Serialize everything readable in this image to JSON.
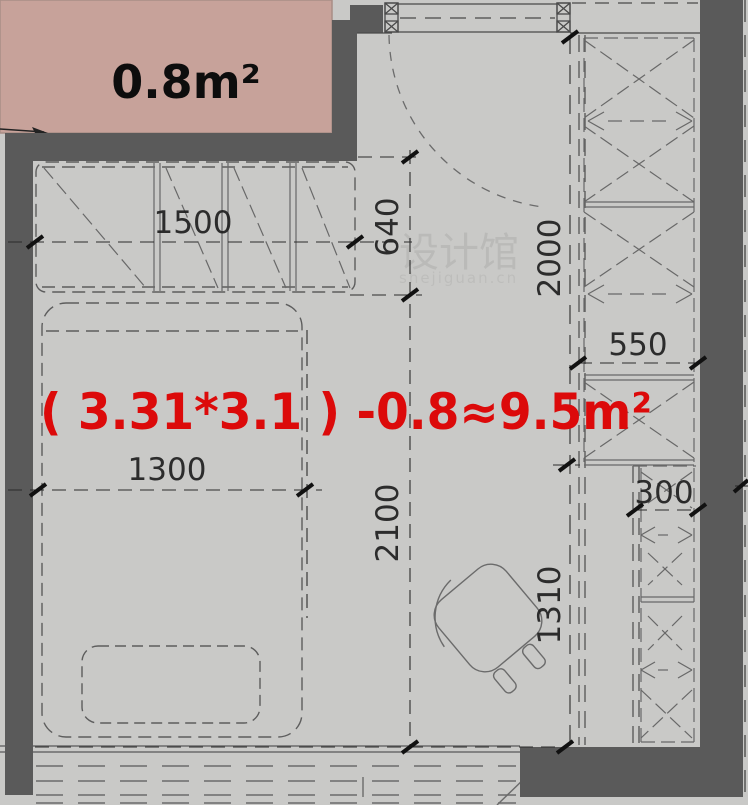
{
  "title": "apartment-floor-plan",
  "colors": {
    "background": "#c9c9c7",
    "wall": "#5a5a5a",
    "highlight_fill": "#c7a29a",
    "highlight_border": "#a98e86",
    "formula_red": "#dc0a0a",
    "label_black": "#111111"
  },
  "labels": {
    "small_area": "0.8m²",
    "formula": "( 3.31*3.1 ) -0.8≈9.5m²"
  },
  "dimensions": {
    "closet_width": "1500",
    "entry_depth": "640",
    "wardrobe_height": "2000",
    "wardrobe_width": "550",
    "cabinet_width": "300",
    "bed_width": "1300",
    "room_length": "2100",
    "cabinet_run_length": "1310"
  },
  "watermark": {
    "name": "设计馆",
    "site": "shejiguan.cn"
  }
}
